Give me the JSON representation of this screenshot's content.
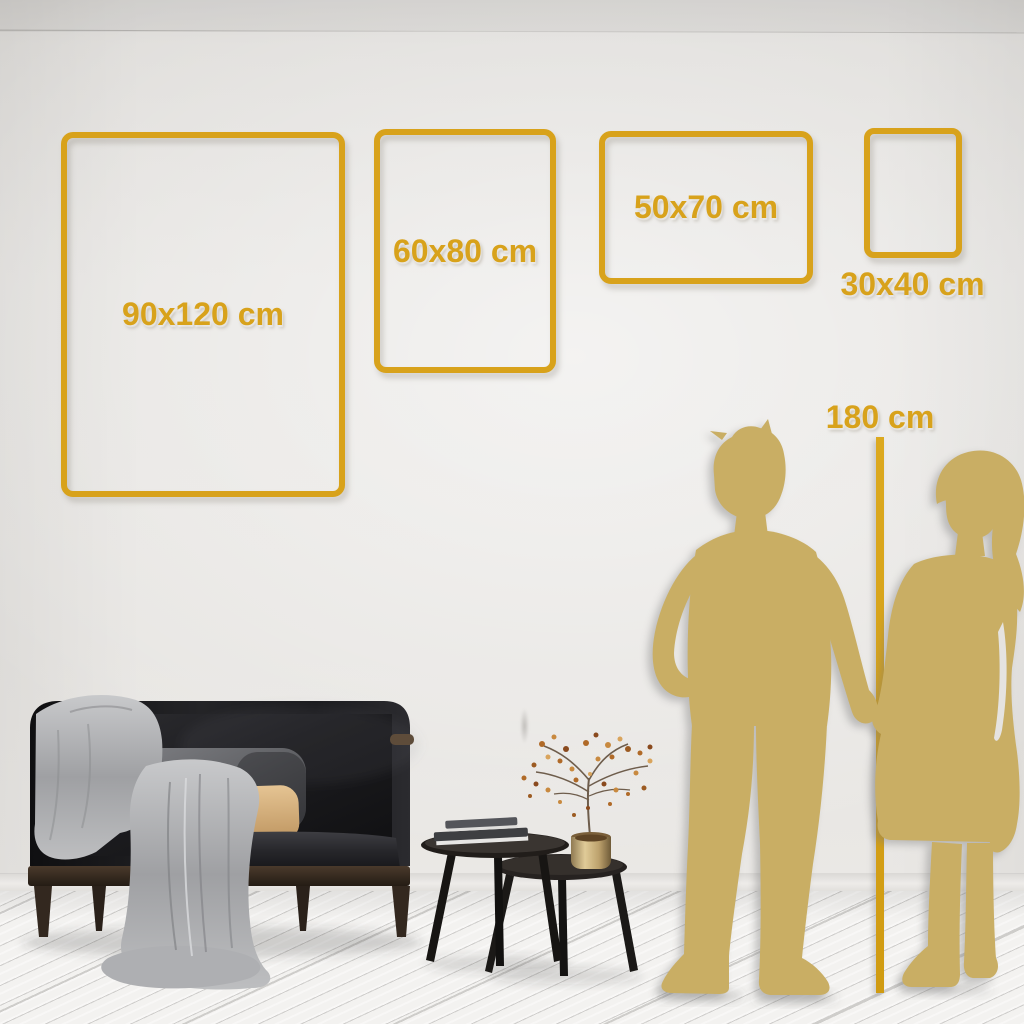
{
  "size_guide": {
    "frames": [
      {
        "id": "90x120",
        "label": "90x120 cm"
      },
      {
        "id": "60x80",
        "label": "60x80 cm"
      },
      {
        "id": "50x70",
        "label": "50x70 cm"
      },
      {
        "id": "30x40",
        "label": "30x40 cm"
      }
    ],
    "height_reference": {
      "label": "180 cm"
    }
  },
  "colors": {
    "accent_gold": "#D8A21B",
    "silhouette_gold": "#C9AE64",
    "wall": "#E6E4E1",
    "floor": "#F3F2F0",
    "sofa_charcoal": "#1B1B1E",
    "blanket_gray": "#A7A8AB",
    "pillow_beige": "#D9B183",
    "vase_brass": "#C7B286"
  },
  "scene": {
    "objects": [
      "man-silhouette",
      "woman-silhouette",
      "height-ruler-line",
      "dark-velvet-sofa",
      "throw-blanket",
      "gray-pillow",
      "beige-pillow",
      "nesting-coffee-tables",
      "book-stack",
      "brass-vase",
      "dried-flower-branch",
      "wood-plank-floor"
    ]
  }
}
